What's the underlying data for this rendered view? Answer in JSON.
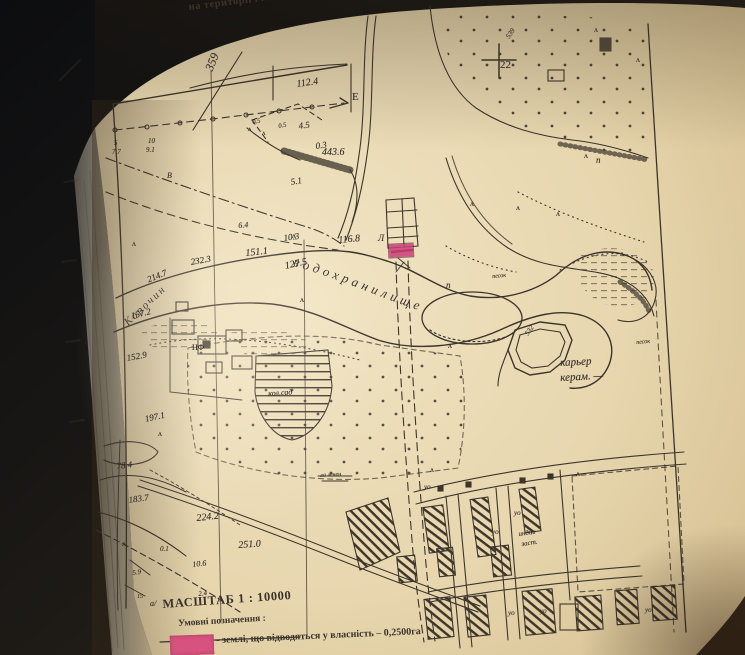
{
  "page": {
    "top_caption": "на території . . . .",
    "scale": "МАСШТАБ 1 : 10000",
    "legend": {
      "title": "Умовні позначення :",
      "item": "- землі, що відводяться у власність – 0,2500га",
      "swatch_color": "#d8527f"
    }
  },
  "map": {
    "ink_color": "#3c352b",
    "paper_color": "#e7d7b2",
    "background_dark": "#15161a",
    "parcel_color": "#cf3f78",
    "water_labels": {
      "river": "Корочин",
      "reservoir": "водохранилище"
    },
    "labels": [
      {
        "t": "359",
        "x": 203,
        "y": 68,
        "s": 12,
        "r": -68,
        "it": 1
      },
      {
        "t": "112.4",
        "x": 296,
        "y": 80,
        "s": 10,
        "r": -8,
        "it": 1
      },
      {
        "t": "Е",
        "x": 352,
        "y": 92,
        "s": 11,
        "r": 0,
        "it": 0
      },
      {
        "t": "5",
        "x": 114,
        "y": 140,
        "s": 7,
        "r": 0,
        "it": 1
      },
      {
        "t": "7.7",
        "x": 112,
        "y": 149,
        "s": 7,
        "r": 0,
        "it": 1
      },
      {
        "t": "10",
        "x": 148,
        "y": 138,
        "s": 7,
        "r": 0,
        "it": 1
      },
      {
        "t": "9.1",
        "x": 146,
        "y": 147,
        "s": 7,
        "r": 0,
        "it": 1
      },
      {
        "t": "0.5",
        "x": 252,
        "y": 120,
        "s": 6.5,
        "r": -10,
        "it": 1
      },
      {
        "t": "0.5",
        "x": 278,
        "y": 124,
        "s": 6.5,
        "r": -10,
        "it": 1
      },
      {
        "t": "4.5",
        "x": 298,
        "y": 122,
        "s": 9,
        "r": -8,
        "it": 1
      },
      {
        "t": "0.3",
        "x": 315,
        "y": 142,
        "s": 9,
        "r": -8,
        "it": 1
      },
      {
        "t": "443.6",
        "x": 322,
        "y": 148,
        "s": 10,
        "r": 0,
        "it": 1
      },
      {
        "t": "5.1",
        "x": 290,
        "y": 178,
        "s": 9,
        "r": -10,
        "it": 1
      },
      {
        "t": "В",
        "x": 167,
        "y": 172,
        "s": 8,
        "r": 0,
        "it": 1
      },
      {
        "t": "6.4",
        "x": 238,
        "y": 222,
        "s": 8,
        "r": -5,
        "it": 1
      },
      {
        "t": "10.3",
        "x": 283,
        "y": 234,
        "s": 9,
        "r": -8,
        "it": 1
      },
      {
        "t": "151.1",
        "x": 245,
        "y": 249,
        "s": 10,
        "r": -6,
        "it": 1
      },
      {
        "t": "116.8",
        "x": 338,
        "y": 236,
        "s": 10,
        "r": -5,
        "it": 1
      },
      {
        "t": "127.5",
        "x": 284,
        "y": 262,
        "s": 10,
        "r": -12,
        "it": 1
      },
      {
        "t": "232.3",
        "x": 190,
        "y": 258,
        "s": 9,
        "r": -10,
        "it": 1
      },
      {
        "t": "214.7",
        "x": 146,
        "y": 276,
        "s": 9,
        "r": -22,
        "it": 1
      },
      {
        "t": "157.2",
        "x": 130,
        "y": 312,
        "s": 9,
        "r": -14,
        "it": 1
      },
      {
        "t": "152.9",
        "x": 126,
        "y": 354,
        "s": 9,
        "r": -10,
        "it": 1
      },
      {
        "t": "197.1",
        "x": 144,
        "y": 415,
        "s": 9,
        "r": -12,
        "it": 1
      },
      {
        "t": "78.4",
        "x": 116,
        "y": 462,
        "s": 9,
        "r": -6,
        "it": 1
      },
      {
        "t": "183.7",
        "x": 128,
        "y": 496,
        "s": 9,
        "r": -8,
        "it": 1
      },
      {
        "t": "224.2",
        "x": 196,
        "y": 514,
        "s": 10,
        "r": -6,
        "it": 1
      },
      {
        "t": "251.0",
        "x": 238,
        "y": 541,
        "s": 10,
        "r": -4,
        "it": 1
      },
      {
        "t": "10.6",
        "x": 192,
        "y": 561,
        "s": 8,
        "r": -6,
        "it": 1
      },
      {
        "t": "0.1",
        "x": 160,
        "y": 546,
        "s": 7,
        "r": 0,
        "it": 1
      },
      {
        "t": "5.9",
        "x": 132,
        "y": 570,
        "s": 7,
        "r": -8,
        "it": 1
      },
      {
        "t": "2.4",
        "x": 198,
        "y": 591,
        "s": 7,
        "r": -6,
        "it": 1
      },
      {
        "t": "15",
        "x": 137,
        "y": 594,
        "s": 6,
        "r": 0,
        "it": 1
      },
      {
        "t": "а/",
        "x": 150,
        "y": 600,
        "s": 8,
        "r": 0,
        "it": 1
      },
      {
        "t": "22",
        "x": 500,
        "y": 60,
        "s": 11,
        "r": 0,
        "it": 0
      },
      {
        "t": "539",
        "x": 505,
        "y": 36,
        "s": 7,
        "r": -55,
        "it": 1
      },
      {
        "t": "п",
        "x": 596,
        "y": 156,
        "s": 9,
        "r": 0,
        "it": 1
      },
      {
        "t": "п",
        "x": 446,
        "y": 281,
        "s": 9,
        "r": 0,
        "it": 1
      },
      {
        "t": "песок",
        "x": 492,
        "y": 274,
        "s": 6,
        "r": -5,
        "it": 1
      },
      {
        "t": "песок",
        "x": 636,
        "y": 340,
        "s": 6,
        "r": -5,
        "it": 1
      },
      {
        "t": "карьер",
        "x": 560,
        "y": 358,
        "s": 11,
        "r": -3,
        "it": 1
      },
      {
        "t": "керам. —",
        "x": 560,
        "y": 373,
        "s": 11,
        "r": -3,
        "it": 1
      },
      {
        "t": "532",
        "x": 524,
        "y": 333,
        "s": 7,
        "r": -55,
        "it": 1
      },
      {
        "t": "кол.сад",
        "x": 268,
        "y": 390,
        "s": 8,
        "r": -4,
        "it": 1
      },
      {
        "t": "НФ",
        "x": 192,
        "y": 344,
        "s": 8,
        "r": 0,
        "it": 0
      },
      {
        "t": "Л",
        "x": 378,
        "y": 234,
        "s": 9,
        "r": 0,
        "it": 1
      },
      {
        "t": "ла лечен",
        "x": 320,
        "y": 473,
        "s": 6,
        "r": -4,
        "it": 1
      },
      {
        "t": "уо",
        "x": 424,
        "y": 484,
        "s": 7,
        "r": 0,
        "it": 1
      },
      {
        "t": "уо",
        "x": 514,
        "y": 510,
        "s": 7,
        "r": 0,
        "it": 1
      },
      {
        "t": "уо",
        "x": 492,
        "y": 529,
        "s": 7,
        "r": 0,
        "it": 1
      },
      {
        "t": "индив",
        "x": 518,
        "y": 531,
        "s": 7,
        "r": -8,
        "it": 1
      },
      {
        "t": "заст.",
        "x": 521,
        "y": 541,
        "s": 7,
        "r": -8,
        "it": 1
      },
      {
        "t": "уо",
        "x": 508,
        "y": 610,
        "s": 7,
        "r": 0,
        "it": 1
      },
      {
        "t": "уо",
        "x": 540,
        "y": 608,
        "s": 7,
        "r": 0,
        "it": 1
      },
      {
        "t": "уо",
        "x": 645,
        "y": 607,
        "s": 7,
        "r": 0,
        "it": 1
      }
    ],
    "symbols": [
      {
        "t": "ʌ",
        "x": 292,
        "y": 232,
        "s": 8,
        "r": 0,
        "it": 0
      },
      {
        "t": "ʌ",
        "x": 594,
        "y": 26,
        "s": 8,
        "r": 0,
        "it": 0
      },
      {
        "t": "ʌ",
        "x": 636,
        "y": 56,
        "s": 8,
        "r": 0,
        "it": 0
      },
      {
        "t": "ʌ",
        "x": 470,
        "y": 200,
        "s": 8,
        "r": 0,
        "it": 0
      },
      {
        "t": "ʌ",
        "x": 516,
        "y": 204,
        "s": 8,
        "r": 0,
        "it": 0
      },
      {
        "t": "ʌ",
        "x": 556,
        "y": 210,
        "s": 8,
        "r": 0,
        "it": 0
      },
      {
        "t": "ʌ",
        "x": 620,
        "y": 250,
        "s": 8,
        "r": 0,
        "it": 0
      },
      {
        "t": "ʌ",
        "x": 300,
        "y": 296,
        "s": 8,
        "r": 0,
        "it": 0
      },
      {
        "t": "ʌ",
        "x": 448,
        "y": 342,
        "s": 8,
        "r": 0,
        "it": 0
      },
      {
        "t": "ʌ",
        "x": 132,
        "y": 240,
        "s": 8,
        "r": 0,
        "it": 0
      },
      {
        "t": "ʌ",
        "x": 158,
        "y": 430,
        "s": 8,
        "r": 0,
        "it": 0
      },
      {
        "t": "ʌ",
        "x": 576,
        "y": 470,
        "s": 8,
        "r": 0,
        "it": 0
      },
      {
        "t": "ʌ",
        "x": 430,
        "y": 466,
        "s": 8,
        "r": 0,
        "it": 0
      },
      {
        "t": "ʌ",
        "x": 122,
        "y": 540,
        "s": 8,
        "r": 0,
        "it": 0
      },
      {
        "t": "ʌ",
        "x": 584,
        "y": 152,
        "s": 8,
        "r": 0,
        "it": 0
      },
      {
        "t": "ʌ",
        "x": 262,
        "y": 130,
        "s": 7,
        "r": 0,
        "it": 0
      },
      {
        "t": "ʌ",
        "x": 248,
        "y": 126,
        "s": 7,
        "r": 0,
        "it": 0
      }
    ]
  }
}
